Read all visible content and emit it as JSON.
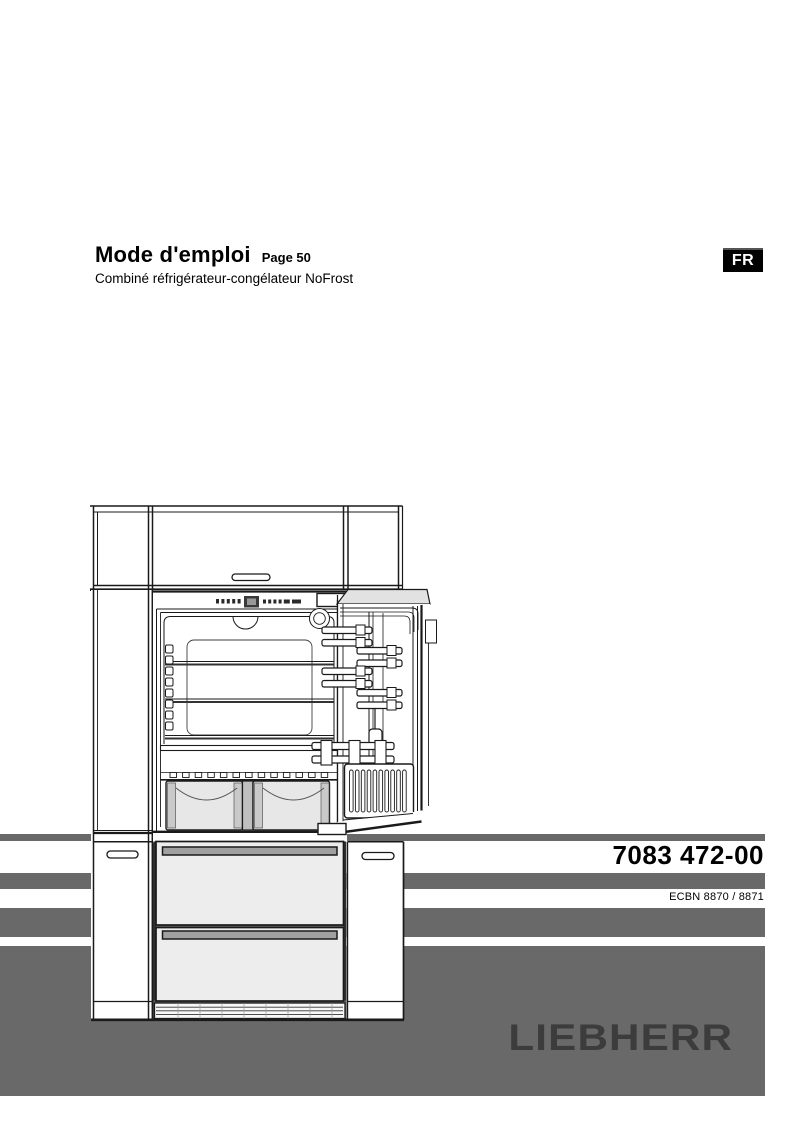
{
  "header": {
    "title": "Mode d'emploi",
    "page_ref": "Page 50",
    "subtitle": "Combiné réfrigérateur-congélateur NoFrost",
    "language_badge": "FR"
  },
  "product": {
    "service_number": "7083 472-00",
    "model_codes": "ECBN 8870 / 8871",
    "brand": "LIEBHERR"
  },
  "illustration": {
    "icon": "built-in-fridge-freezer-line-drawing"
  },
  "colors": {
    "band_gray": "#696969",
    "logo_gray": "#3c3c3c",
    "badge_bg": "#000000",
    "badge_text": "#ffffff"
  }
}
